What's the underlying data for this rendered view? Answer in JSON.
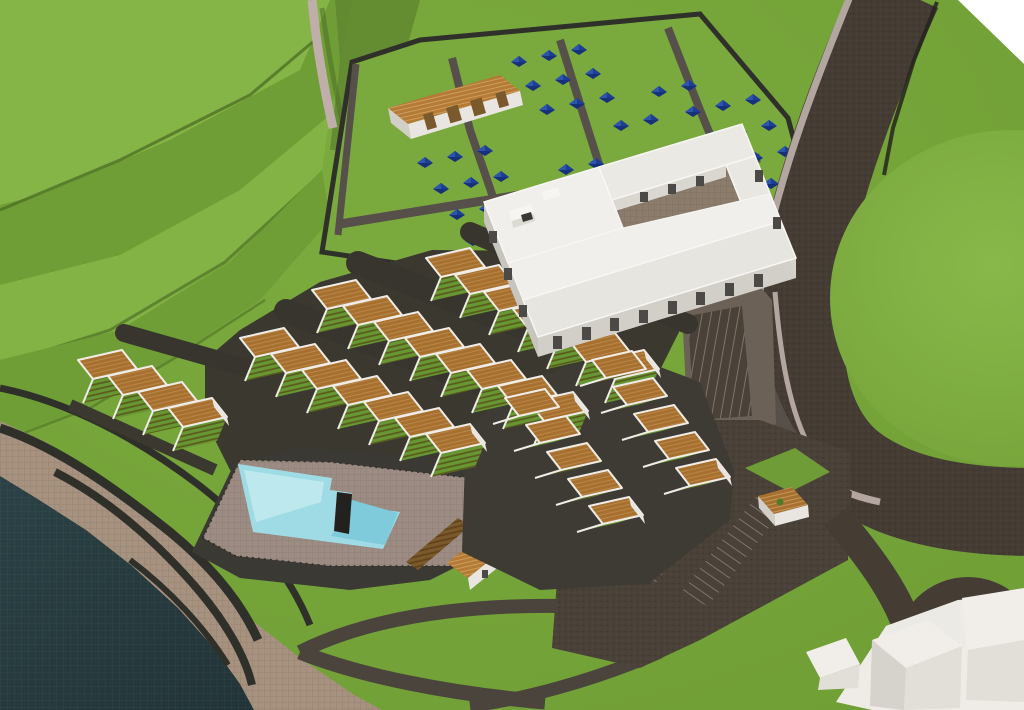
{
  "meta": {
    "title": "3D aerial site-plan rendering of a coastal resort development",
    "view": "bird's-eye perspective",
    "counts": {
      "tents": 41,
      "townhouse_units": 26,
      "villa_units": 10,
      "parking_lots": 4,
      "pools": 1
    }
  },
  "colors": {
    "grass": "#76a33a",
    "grassLight": "#85b546",
    "grassMid": "#6f9e36",
    "grassDark": "#5d8430",
    "ridgeShadow": "#4e7026",
    "circleGrass": "#7fae40",
    "road": "#453c34",
    "roadMid": "#57504a",
    "internalLot": "#6b6157",
    "sidewalk": "#b3a6a1",
    "pathPink": "#bfaeaa",
    "street": "#38352e",
    "wallDark": "#30302a",
    "water": "#273a3d",
    "shore": "#a6927f",
    "roof": "#a8702e",
    "roofLight": "#b57a33",
    "parapet": "#f0ede8",
    "wallWhite": "#e9e6e1",
    "wallShade": "#d2cfc9",
    "wallShade2": "#c8c5bf",
    "pergola": "#7a5a2c",
    "pergolaDark": "#5f431f",
    "tent": "#16317a",
    "tentLight": "#2e55ad",
    "tentMid": "#1d3f93",
    "poolWater": "#9fdbe5",
    "poolShallow": "#c0e9ee",
    "poolDeep": "#7fcbdb",
    "poolDeck": "#9c8c83",
    "bldRoofA": "#f0efeb",
    "bldRoofB": "#e7e5df",
    "bldRoofC": "#ebe9e4",
    "bldRoofD": "#e9e7e2",
    "window": "#4b4a47",
    "courtyard": "#8b7c6c",
    "parking": "#4a4238",
    "stripe": "#a49d93",
    "massing": "#f1eeea",
    "massingFront": "#e2dfd9",
    "massingSide": "#d6d3cd",
    "terraceGrass": "#679733",
    "voidWhite": "#ffffff"
  },
  "scene": {
    "camping": {
      "tent_count": 41,
      "tents": [
        [
          519,
          62
        ],
        [
          549,
          56
        ],
        [
          579,
          50
        ],
        [
          533,
          86
        ],
        [
          563,
          80
        ],
        [
          593,
          74
        ],
        [
          547,
          110
        ],
        [
          577,
          104
        ],
        [
          607,
          98
        ],
        [
          621,
          126
        ],
        [
          651,
          120
        ],
        [
          693,
          112
        ],
        [
          723,
          106
        ],
        [
          753,
          100
        ],
        [
          709,
          138
        ],
        [
          739,
          132
        ],
        [
          769,
          126
        ],
        [
          725,
          164
        ],
        [
          755,
          158
        ],
        [
          785,
          152
        ],
        [
          741,
          190
        ],
        [
          771,
          184
        ],
        [
          799,
          178
        ],
        [
          425,
          163
        ],
        [
          455,
          157
        ],
        [
          485,
          151
        ],
        [
          441,
          189
        ],
        [
          471,
          183
        ],
        [
          501,
          177
        ],
        [
          457,
          215
        ],
        [
          487,
          209
        ],
        [
          517,
          203
        ],
        [
          473,
          241
        ],
        [
          503,
          235
        ],
        [
          533,
          229
        ],
        [
          566,
          170
        ],
        [
          596,
          164
        ],
        [
          582,
          196
        ],
        [
          612,
          190
        ],
        [
          659,
          92
        ],
        [
          689,
          86
        ]
      ]
    },
    "terrace_rows": [
      {
        "id": "left-row",
        "x": 78,
        "y": 360,
        "n": 4,
        "u": [
          44,
          -10
        ],
        "d": [
          15,
          19
        ],
        "s": [
          30,
          16
        ],
        "t": [
          -10,
          24
        ],
        "back": [
          46,
          -27
        ],
        "backw": 18
      },
      {
        "id": "row-a",
        "x": 240,
        "y": 338,
        "n": 7,
        "u": [
          44,
          -10
        ],
        "d": [
          15,
          19
        ],
        "s": [
          31,
          16
        ],
        "t": [
          -10,
          24
        ],
        "back": [
          46,
          -27
        ],
        "backw": 24
      },
      {
        "id": "row-b",
        "x": 312,
        "y": 290,
        "n": 8,
        "u": [
          44,
          -10
        ],
        "d": [
          15,
          19
        ],
        "s": [
          31,
          16
        ],
        "t": [
          -10,
          24
        ],
        "back": [
          46,
          -27
        ],
        "backw": 24
      },
      {
        "id": "row-c",
        "x": 426,
        "y": 258,
        "n": 7,
        "u": [
          44,
          -10
        ],
        "d": [
          15,
          19
        ],
        "s": [
          29,
          17
        ],
        "t": [
          -10,
          24
        ],
        "back": [
          44,
          -26
        ],
        "backw": 20
      }
    ],
    "villa_cluster": [
      {
        "id": "cluster-1",
        "x": 505,
        "y": 398,
        "n": 5,
        "u": [
          40,
          -9
        ],
        "d": [
          14,
          18
        ],
        "s": [
          21,
          27
        ],
        "t": [
          -26,
          8
        ]
      },
      {
        "id": "cluster-2",
        "x": 592,
        "y": 360,
        "n": 5,
        "u": [
          40,
          -9
        ],
        "d": [
          14,
          18
        ],
        "s": [
          21,
          27
        ],
        "t": [
          -26,
          8
        ]
      }
    ],
    "parking": {
      "lots": [
        {
          "points": "575,545 640,450 670,462 605,557",
          "stripes": "A"
        },
        {
          "points": "627,572 702,472 730,484 655,584",
          "stripes": "A"
        },
        {
          "points": "680,594 758,494 786,506 708,606",
          "stripes": "A"
        },
        {
          "points": "694,420 688,316 742,306 752,416",
          "stripes": "B"
        }
      ]
    }
  }
}
